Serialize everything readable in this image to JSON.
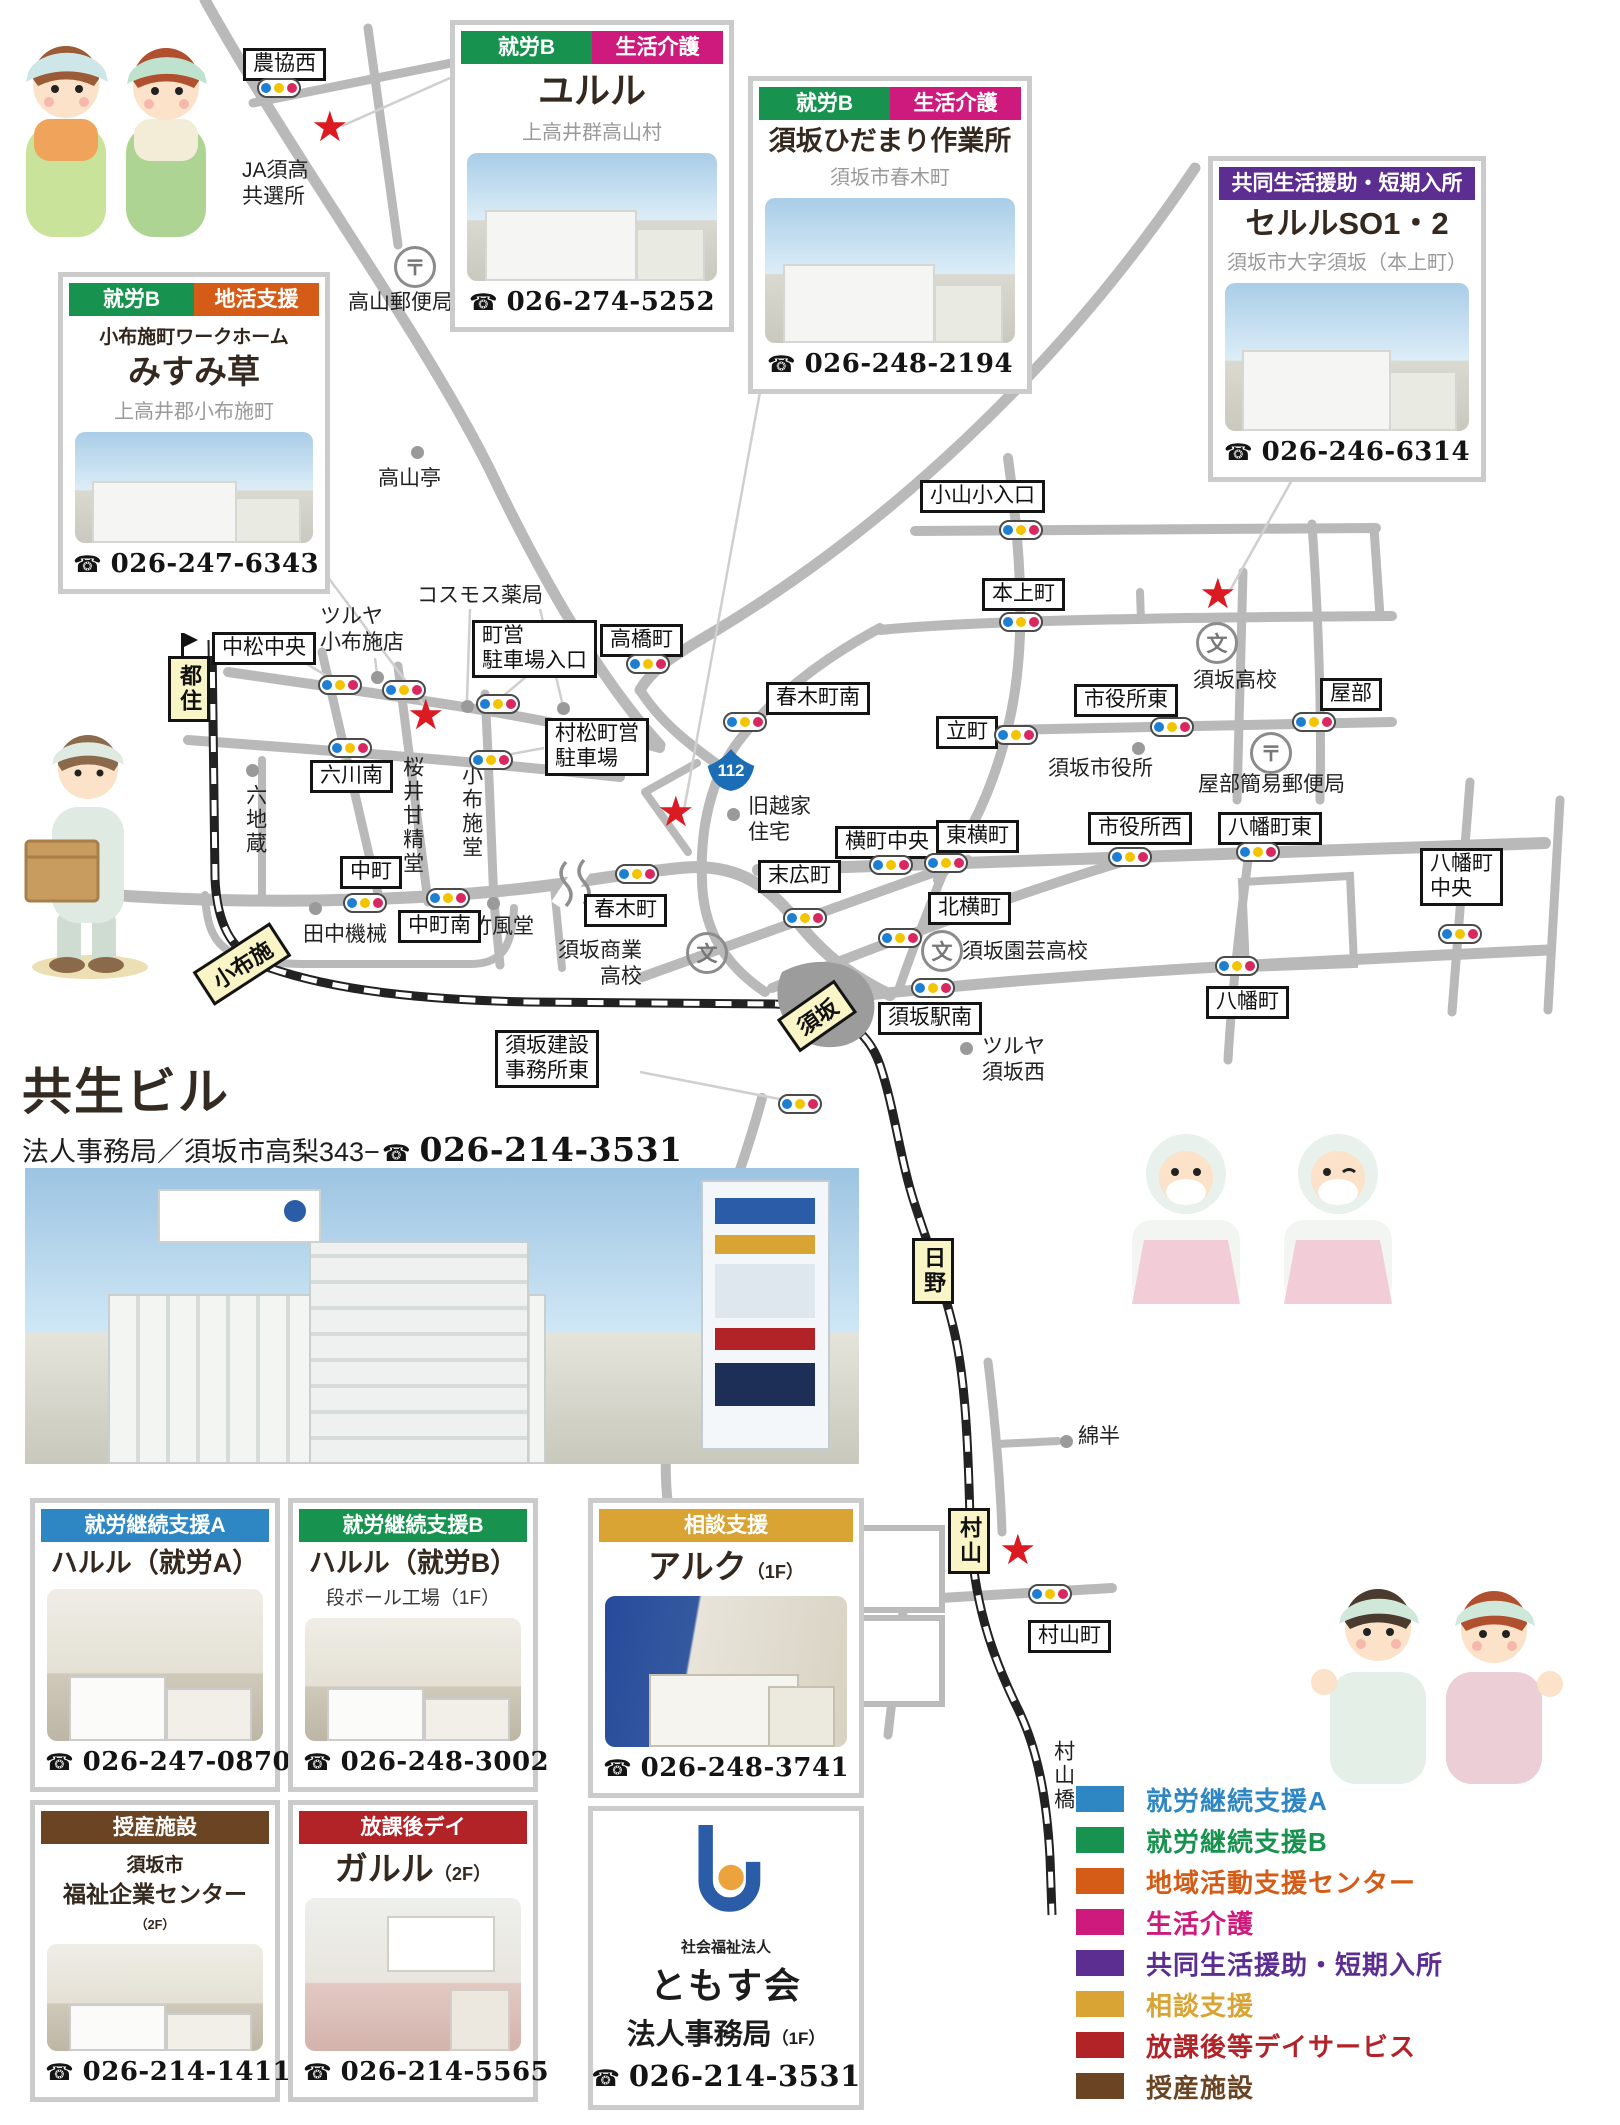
{
  "building_section": {
    "title": "共生ビル",
    "address": "法人事務局／須坂市高梨343−",
    "phone": "026-214-3531"
  },
  "corp": {
    "org_type": "社会福祉法人",
    "org": "ともす会",
    "dept": "法人事務局",
    "dept_floor": "（1F）",
    "phone": "026-214-3531"
  },
  "phone_icon": "☎",
  "cards": [
    {
      "id": "yururu",
      "x": 450,
      "y": 20,
      "w": 284,
      "h": 312,
      "tsize": 36,
      "badges": [
        {
          "label": "就労B",
          "color": "#17934f"
        },
        {
          "label": "生活介護",
          "color": "#ce1a7d"
        }
      ],
      "title": "ユルル",
      "subtitle": "上高井群高山村",
      "photo": "ext",
      "phone": "026-274-5252"
    },
    {
      "id": "hidamari",
      "x": 748,
      "y": 76,
      "w": 284,
      "h": 318,
      "tsize": 27,
      "badges": [
        {
          "label": "就労B",
          "color": "#17934f"
        },
        {
          "label": "生活介護",
          "color": "#ce1a7d"
        }
      ],
      "title": "須坂ひだまり作業所",
      "subtitle": "須坂市春木町",
      "photo": "ext",
      "phone": "026-248-2194"
    },
    {
      "id": "seruru",
      "x": 1208,
      "y": 156,
      "w": 278,
      "h": 326,
      "tsize": 31,
      "badges": [
        {
          "label": "共同生活援助・短期入所",
          "color": "#5c2e91"
        }
      ],
      "title": "セルルSO1・2",
      "subtitle": "須坂市大字須坂（本上町）",
      "photo": "ext",
      "phone": "026-246-6314"
    },
    {
      "id": "misumi",
      "x": 58,
      "y": 272,
      "w": 272,
      "h": 322,
      "tsize": 33,
      "badges": [
        {
          "label": "就労B",
          "color": "#17934f"
        },
        {
          "label": "地活支援",
          "color": "#d55c17"
        }
      ],
      "pret": "小布施町ワークホーム",
      "title": "みすみ草",
      "subtitle": "上高井郡小布施町",
      "photo": "ext",
      "phone": "026-247-6343"
    },
    {
      "id": "haruru-a",
      "x": 30,
      "y": 1498,
      "w": 250,
      "h": 294,
      "tsize": 27,
      "badges": [
        {
          "label": "就労継続支援A",
          "color": "#2e87c3"
        }
      ],
      "title": "ハルル（就労A）",
      "photo": "int",
      "phone": "026-247-0870"
    },
    {
      "id": "haruru-b",
      "x": 288,
      "y": 1498,
      "w": 250,
      "h": 294,
      "tsize": 27,
      "badges": [
        {
          "label": "就労継続支援B",
          "color": "#17934f"
        }
      ],
      "title": "ハルル（就労B）",
      "note": "段ボール工場（1F）",
      "photo": "int",
      "phone": "026-248-3002"
    },
    {
      "id": "aruku",
      "x": 588,
      "y": 1498,
      "w": 276,
      "h": 300,
      "tsize": 33,
      "badges": [
        {
          "label": "相談支援",
          "color": "#d9a433"
        }
      ],
      "title": "アルク",
      "tsmall": "（1F）",
      "photo": "blue",
      "phone": "026-248-3741"
    },
    {
      "id": "fukushi",
      "x": 30,
      "y": 1800,
      "w": 250,
      "h": 302,
      "tsize": 23,
      "badges": [
        {
          "label": "授産施設",
          "color": "#6b4423"
        }
      ],
      "pret": "須坂市",
      "title": "福祉企業センター",
      "tsmall": "（2F）",
      "photo": "int",
      "phone": "026-214-1411"
    },
    {
      "id": "garuru",
      "x": 288,
      "y": 1800,
      "w": 250,
      "h": 302,
      "tsize": 33,
      "badges": [
        {
          "label": "放課後デイ",
          "color": "#b22328"
        }
      ],
      "title": "ガルル",
      "tsmall": "（2F）",
      "photo": "kids",
      "phone": "026-214-5565"
    }
  ],
  "legend": {
    "items": [
      {
        "label": "就労継続支援A",
        "color": "#2e87c3"
      },
      {
        "label": "就労継続支援B",
        "color": "#17934f"
      },
      {
        "label": "地域活動支援センター",
        "color": "#d55c17"
      },
      {
        "label": "生活介護",
        "color": "#ce1a7d"
      },
      {
        "label": "共同生活援助・短期入所",
        "color": "#5c2e91"
      },
      {
        "label": "相談支援",
        "color": "#d9a433"
      },
      {
        "label": "放課後等デイサービス",
        "color": "#b22328"
      },
      {
        "label": "授産施設",
        "color": "#6b4423"
      }
    ]
  },
  "map": {
    "tl_colors": [
      "#1d7fd1",
      "#f3c400",
      "#d8285f"
    ],
    "route_badge": {
      "text": "112",
      "x": 706,
      "y": 747,
      "color": "#1b6db5"
    },
    "boxed_labels": [
      {
        "text": "農協西",
        "x": 243,
        "y": 48
      },
      {
        "text": "中松中央",
        "x": 212,
        "y": 632
      },
      {
        "text": "町営\n駐車場入口",
        "x": 472,
        "y": 620
      },
      {
        "text": "高橋町",
        "x": 600,
        "y": 624
      },
      {
        "text": "春木町南",
        "x": 766,
        "y": 682
      },
      {
        "text": "小山小入口",
        "x": 920,
        "y": 480
      },
      {
        "text": "本上町",
        "x": 982,
        "y": 578
      },
      {
        "text": "市役所東",
        "x": 1074,
        "y": 684
      },
      {
        "text": "屋部",
        "x": 1320,
        "y": 678
      },
      {
        "text": "立町",
        "x": 936,
        "y": 716
      },
      {
        "text": "村松町営\n駐車場",
        "x": 545,
        "y": 718
      },
      {
        "text": "六川南",
        "x": 310,
        "y": 760
      },
      {
        "text": "横町中央",
        "x": 835,
        "y": 826
      },
      {
        "text": "東横町",
        "x": 936,
        "y": 820
      },
      {
        "text": "市役所西",
        "x": 1088,
        "y": 812
      },
      {
        "text": "八幡町東",
        "x": 1218,
        "y": 812
      },
      {
        "text": "末広町",
        "x": 758,
        "y": 860
      },
      {
        "text": "北横町",
        "x": 928,
        "y": 892
      },
      {
        "text": "八幡町\n中央",
        "x": 1420,
        "y": 848
      },
      {
        "text": "中町",
        "x": 340,
        "y": 856
      },
      {
        "text": "中町南",
        "x": 398,
        "y": 910
      },
      {
        "text": "春木町",
        "x": 584,
        "y": 894
      },
      {
        "text": "八幡町",
        "x": 1206,
        "y": 986
      },
      {
        "text": "須坂駅南",
        "x": 878,
        "y": 1002
      },
      {
        "text": "須坂建設\n事務所東",
        "x": 495,
        "y": 1030
      },
      {
        "text": "村山町",
        "x": 1028,
        "y": 1620
      }
    ],
    "plain_labels": [
      {
        "text": "JA須高\n共選所",
        "x": 242,
        "y": 158
      },
      {
        "text": "高山郵便局",
        "x": 348,
        "y": 290
      },
      {
        "text": "高山亭",
        "x": 378,
        "y": 466
      },
      {
        "text": "コスモス薬局",
        "x": 417,
        "y": 583
      },
      {
        "text": "ツルヤ\n小布施店",
        "x": 320,
        "y": 604
      },
      {
        "text": "六地蔵",
        "x": 242,
        "y": 784,
        "v": true
      },
      {
        "text": "桜井甘精堂",
        "x": 399,
        "y": 756,
        "v": true
      },
      {
        "text": "小布施堂",
        "x": 458,
        "y": 764,
        "v": true
      },
      {
        "text": "田中機械",
        "x": 303,
        "y": 922
      },
      {
        "text": "竹風堂",
        "x": 471,
        "y": 914
      },
      {
        "text": "須坂商業\n高校",
        "x": 558,
        "y": 938,
        "r": true
      },
      {
        "text": "旧越家\n住宅",
        "x": 748,
        "y": 794
      },
      {
        "text": "須坂市役所",
        "x": 1048,
        "y": 756
      },
      {
        "text": "須坂高校",
        "x": 1193,
        "y": 668
      },
      {
        "text": "屋部簡易郵便局",
        "x": 1198,
        "y": 772
      },
      {
        "text": "須坂園芸高校",
        "x": 962,
        "y": 939
      },
      {
        "text": "ツルヤ\n須坂西",
        "x": 982,
        "y": 1034
      },
      {
        "text": "綿半",
        "x": 1078,
        "y": 1424
      },
      {
        "text": "村山橋",
        "x": 1050,
        "y": 1740,
        "v": true
      }
    ],
    "stations": [
      {
        "name": "都住",
        "x": 168,
        "y": 656,
        "v": true,
        "flag": true
      },
      {
        "name": "小布施",
        "x": 196,
        "y": 944,
        "rot": -33
      },
      {
        "name": "須坂",
        "x": 782,
        "y": 996,
        "rot": -35
      },
      {
        "name": "日野",
        "x": 912,
        "y": 1238,
        "v": true
      },
      {
        "name": "村山",
        "x": 948,
        "y": 1508,
        "v": true
      }
    ],
    "traffic_lights": [
      [
        279,
        88
      ],
      [
        340,
        685
      ],
      [
        404,
        690
      ],
      [
        498,
        704
      ],
      [
        648,
        664
      ],
      [
        350,
        748
      ],
      [
        491,
        760
      ],
      [
        745,
        722
      ],
      [
        1021,
        530
      ],
      [
        1021,
        622
      ],
      [
        1016,
        735
      ],
      [
        1172,
        727
      ],
      [
        1314,
        722
      ],
      [
        891,
        865
      ],
      [
        946,
        863
      ],
      [
        1130,
        857
      ],
      [
        1258,
        852
      ],
      [
        805,
        918
      ],
      [
        900,
        938
      ],
      [
        933,
        988
      ],
      [
        1237,
        966
      ],
      [
        365,
        903
      ],
      [
        448,
        898
      ],
      [
        637,
        874
      ],
      [
        800,
        1104
      ],
      [
        1050,
        1594
      ],
      [
        1460,
        934
      ]
    ],
    "stars": [
      [
        332,
        130
      ],
      [
        428,
        718
      ],
      [
        678,
        815
      ],
      [
        1220,
        597
      ],
      [
        1020,
        1553
      ]
    ],
    "dots": [
      [
        417,
        452
      ],
      [
        467,
        706
      ],
      [
        563,
        708
      ],
      [
        377,
        677
      ],
      [
        252,
        770
      ],
      [
        315,
        908
      ],
      [
        493,
        903
      ],
      [
        733,
        814
      ],
      [
        1138,
        748
      ],
      [
        966,
        1048
      ],
      [
        1066,
        1441
      ]
    ],
    "icons": [
      {
        "glyph": "〒",
        "kind": "post-office-icon",
        "x": 394,
        "y": 246
      },
      {
        "glyph": "〒",
        "kind": "post-office-icon",
        "x": 1250,
        "y": 732
      },
      {
        "glyph": "文",
        "kind": "school-icon",
        "x": 1196,
        "y": 622
      },
      {
        "glyph": "文",
        "kind": "school-icon",
        "x": 921,
        "y": 930
      },
      {
        "glyph": "文",
        "kind": "school-icon",
        "x": 686,
        "y": 932
      }
    ]
  }
}
